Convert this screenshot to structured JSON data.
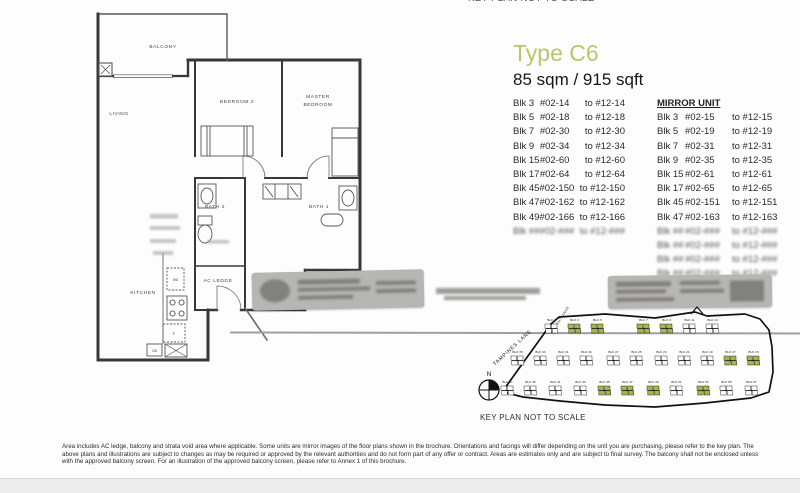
{
  "page": {
    "top_cutoff_text": "KEY PLAN NOT TO SCALE",
    "title": "Type C6",
    "area": "85 sqm / 915 sqft",
    "mirror_header": "MIRROR UNIT",
    "keyplan_caption": "KEY PLAN NOT TO SCALE",
    "disclaimer": "Area includes AC ledge, balcony and strata void area where applicable. Some units are mirror images of the floor plans shown in the brochure. Orientations and facings will differ depending on the unit you are purchasing, please refer to the key plan. The above plans and illustrations are subject to changes as may be required or approved by the relevant authorities and do not form part of any offer or contract. Areas are estimates only and are subject to final survey. The balcony shall not be enclosed unless with the approved balcony screen. For an illustration of the approved balcony screen, please refer to Annex 1 of this brochure.",
    "colors": {
      "title_green": "#b6c86a",
      "keyplan_block_green": "#a4b944"
    }
  },
  "units": [
    {
      "blk": "Blk 3",
      "from": "#02-14",
      "to": "to #12-14",
      "blurred": false
    },
    {
      "blk": "Blk 5",
      "from": "#02-18",
      "to": "to #12-18",
      "blurred": false
    },
    {
      "blk": "Blk 7",
      "from": "#02-30",
      "to": "to #12-30",
      "blurred": false
    },
    {
      "blk": "Blk 9",
      "from": "#02-34",
      "to": "to #12-34",
      "blurred": false
    },
    {
      "blk": "Blk 15",
      "from": "#02-60",
      "to": "to #12-60",
      "blurred": false
    },
    {
      "blk": "Blk 17",
      "from": "#02-64",
      "to": "to #12-64",
      "blurred": false
    },
    {
      "blk": "Blk 45",
      "from": "#02-150",
      "to": "to #12-150",
      "blurred": false
    },
    {
      "blk": "Blk 47",
      "from": "#02-162",
      "to": "to #12-162",
      "blurred": false
    },
    {
      "blk": "Blk 49",
      "from": "#02-166",
      "to": "to #12-166",
      "blurred": false
    },
    {
      "blk": "Blk ##",
      "from": "#02-###",
      "to": "to #12-###",
      "blurred": true
    }
  ],
  "mirror_units": [
    {
      "blk": "Blk 3",
      "from": "#02-15",
      "to": "to #12-15",
      "blurred": false
    },
    {
      "blk": "Blk 5",
      "from": "#02-19",
      "to": "to #12-19",
      "blurred": false
    },
    {
      "blk": "Blk 7",
      "from": "#02-31",
      "to": "to #12-31",
      "blurred": false
    },
    {
      "blk": "Blk 9",
      "from": "#02-35",
      "to": "to #12-35",
      "blurred": false
    },
    {
      "blk": "Blk 15",
      "from": "#02-61",
      "to": "to #12-61",
      "blurred": false
    },
    {
      "blk": "Blk 17",
      "from": "#02-65",
      "to": "to #12-65",
      "blurred": false
    },
    {
      "blk": "Blk 45",
      "from": "#02-151",
      "to": "to #12-151",
      "blurred": false
    },
    {
      "blk": "Blk 47",
      "from": "#02-163",
      "to": "to #12-163",
      "blurred": false
    },
    {
      "blk": "Blk ##",
      "from": "#02-###",
      "to": "to #12-###",
      "blurred": true
    },
    {
      "blk": "Blk ##",
      "from": "#02-###",
      "to": "to #12-###",
      "blurred": true
    },
    {
      "blk": "Blk ##",
      "from": "#02-###",
      "to": "to #12-###",
      "blurred": true
    },
    {
      "blk": "Blk ##",
      "from": "#02-###",
      "to": "to #12-###",
      "blurred": true
    }
  ],
  "floorplan": {
    "labels": {
      "balcony": "BALCONY",
      "living": "LIVING",
      "bedroom2": "BEDROOM 2",
      "master1": "MASTER",
      "master2": "BEDROOM",
      "bath2": "BATH 2",
      "bath1": "BATH 1",
      "ac_ledge": "AC LEDGE",
      "kitchen": "KITCHEN",
      "wd": "WD",
      "fridge": "F",
      "db": "DB"
    }
  },
  "keyplan": {
    "compass": "N",
    "road_label": "TAMPINES LANE",
    "entrance_label": "MAIN ENTRANCE",
    "rows": [
      {
        "y": 22,
        "ly": 19,
        "clusters": [
          {
            "x": 90,
            "label": "BLK 1",
            "green": false
          },
          {
            "x": 113,
            "label": "BLK 3",
            "green": true
          },
          {
            "x": 136,
            "label": "BLK 5",
            "green": true
          },
          {
            "x": 182,
            "label": "BLK 7",
            "green": true
          },
          {
            "x": 205,
            "label": "BLK 9",
            "green": true
          },
          {
            "x": 228,
            "label": "BLK 11",
            "green": false
          },
          {
            "x": 251,
            "label": "BLK 13",
            "green": false
          }
        ]
      },
      {
        "y": 54,
        "ly": 51,
        "clusters": [
          {
            "x": 56,
            "label": "BLK 35",
            "green": false
          },
          {
            "x": 79,
            "label": "BLK 33",
            "green": false
          },
          {
            "x": 102,
            "label": "BLK 31",
            "green": false
          },
          {
            "x": 125,
            "label": "BLK 29",
            "green": false
          },
          {
            "x": 152,
            "label": "BLK 27",
            "green": false
          },
          {
            "x": 175,
            "label": "BLK 25",
            "green": false
          },
          {
            "x": 200,
            "label": "BLK 23",
            "green": false
          },
          {
            "x": 223,
            "label": "BLK 21",
            "green": false
          },
          {
            "x": 246,
            "label": "BLK 19",
            "green": false
          },
          {
            "x": 269,
            "label": "BLK 17",
            "green": true
          },
          {
            "x": 292,
            "label": "BLK 15",
            "green": true
          }
        ]
      },
      {
        "y": 84,
        "ly": 81,
        "clusters": [
          {
            "x": 46,
            "label": "BLK 37",
            "green": false
          },
          {
            "x": 69,
            "label": "BLK 39",
            "green": false
          },
          {
            "x": 94,
            "label": "BLK 41",
            "green": false
          },
          {
            "x": 119,
            "label": "BLK 43",
            "green": false
          },
          {
            "x": 143,
            "label": "BLK 45",
            "green": true
          },
          {
            "x": 166,
            "label": "BLK 47",
            "green": true
          },
          {
            "x": 192,
            "label": "BLK 49",
            "green": true
          },
          {
            "x": 215,
            "label": "BLK 51",
            "green": false
          },
          {
            "x": 242,
            "label": "BLK 53",
            "green": true
          },
          {
            "x": 265,
            "label": "BLK 55",
            "green": false
          },
          {
            "x": 290,
            "label": "BLK 57",
            "green": false
          }
        ]
      }
    ]
  }
}
